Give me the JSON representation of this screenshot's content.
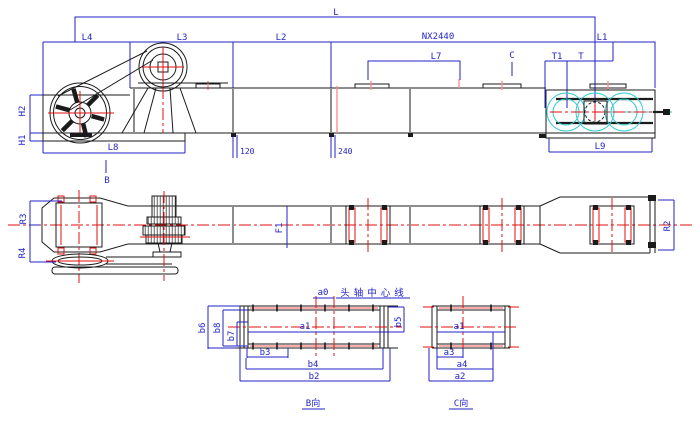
{
  "colors": {
    "dimension_blue": "#2323c8",
    "geometry_black": "#1b1b1b",
    "centerline_red": "#e01212",
    "soft_red": "#ff8d8d",
    "aux_cyan": "#2fcaca",
    "joint_gray": "#8c8c8c"
  },
  "front_view": {
    "dim_overall": "L",
    "dim_l4": "L4",
    "dim_l3": "L3",
    "dim_l2": "L2",
    "dim_pitch": "NX2440",
    "dim_l1": "L1",
    "dim_l7": "L7",
    "dim_t1": "T1",
    "dim_t": "T",
    "dim_h2": "H2",
    "dim_h1": "H1",
    "dim_l8": "L8",
    "dim_120": "120",
    "dim_240": "240",
    "dim_l9": "L9",
    "view_marker_b": "B",
    "view_marker_c": "C"
  },
  "plan_view": {
    "dim_r3": "R3",
    "dim_r4": "R4",
    "dim_f1": "F1",
    "dim_r2": "R2"
  },
  "detail_view_b": {
    "title": "B向",
    "note_head_axle_centerline": "头轴中心线",
    "dim_a0": "a0",
    "dim_a1": "a1",
    "dim_b2": "b2",
    "dim_b3": "b3",
    "dim_b4": "b4",
    "dim_b5": "b5",
    "dim_b6": "b6",
    "dim_b7": "b7",
    "dim_b8": "b8"
  },
  "detail_view_c": {
    "title": "C向",
    "dim_a1": "a1",
    "dim_a2": "a2",
    "dim_a3": "a3",
    "dim_a4": "a4"
  }
}
